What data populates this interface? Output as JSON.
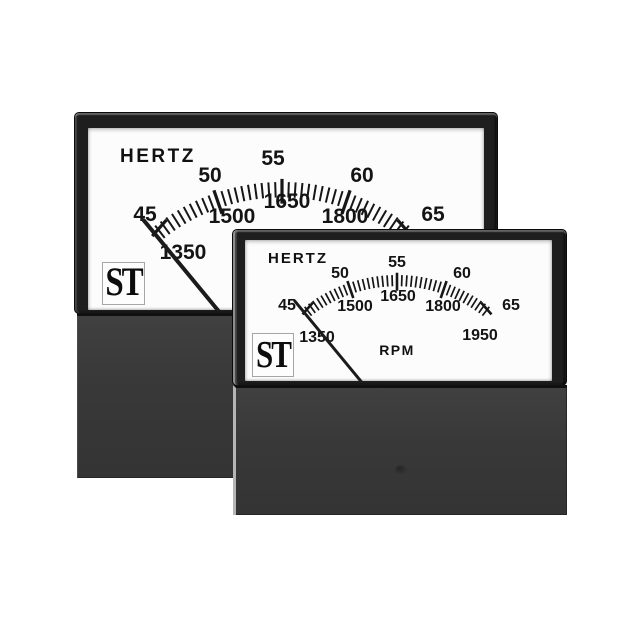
{
  "meters": {
    "back": {
      "brand": "ST",
      "primary_unit": "HERTZ",
      "secondary_unit": "RPM",
      "scale": {
        "min": 45,
        "max": 65,
        "major_step": 5,
        "minor_step": 0.5,
        "primary_labels": [
          "45",
          "50",
          "55",
          "60",
          "65"
        ],
        "secondary_labels": [
          "1350",
          "1500",
          "1650",
          "1800",
          "1950"
        ],
        "needle_value": 45
      }
    },
    "front": {
      "brand": "ST",
      "primary_unit": "HERTZ",
      "secondary_unit": "RPM",
      "scale": {
        "min": 45,
        "max": 65,
        "major_step": 5,
        "minor_step": 0.5,
        "primary_labels": [
          "45",
          "50",
          "55",
          "60",
          "65"
        ],
        "secondary_labels": [
          "1350",
          "1500",
          "1650",
          "1800",
          "1950"
        ],
        "needle_value": 45
      }
    }
  },
  "colors": {
    "background": "#ffffff",
    "face": "#fcfcfc",
    "bezel": "#1e1e1e",
    "body": "#383838",
    "markings": "#161616",
    "logo_border": "#a6a6a6"
  }
}
